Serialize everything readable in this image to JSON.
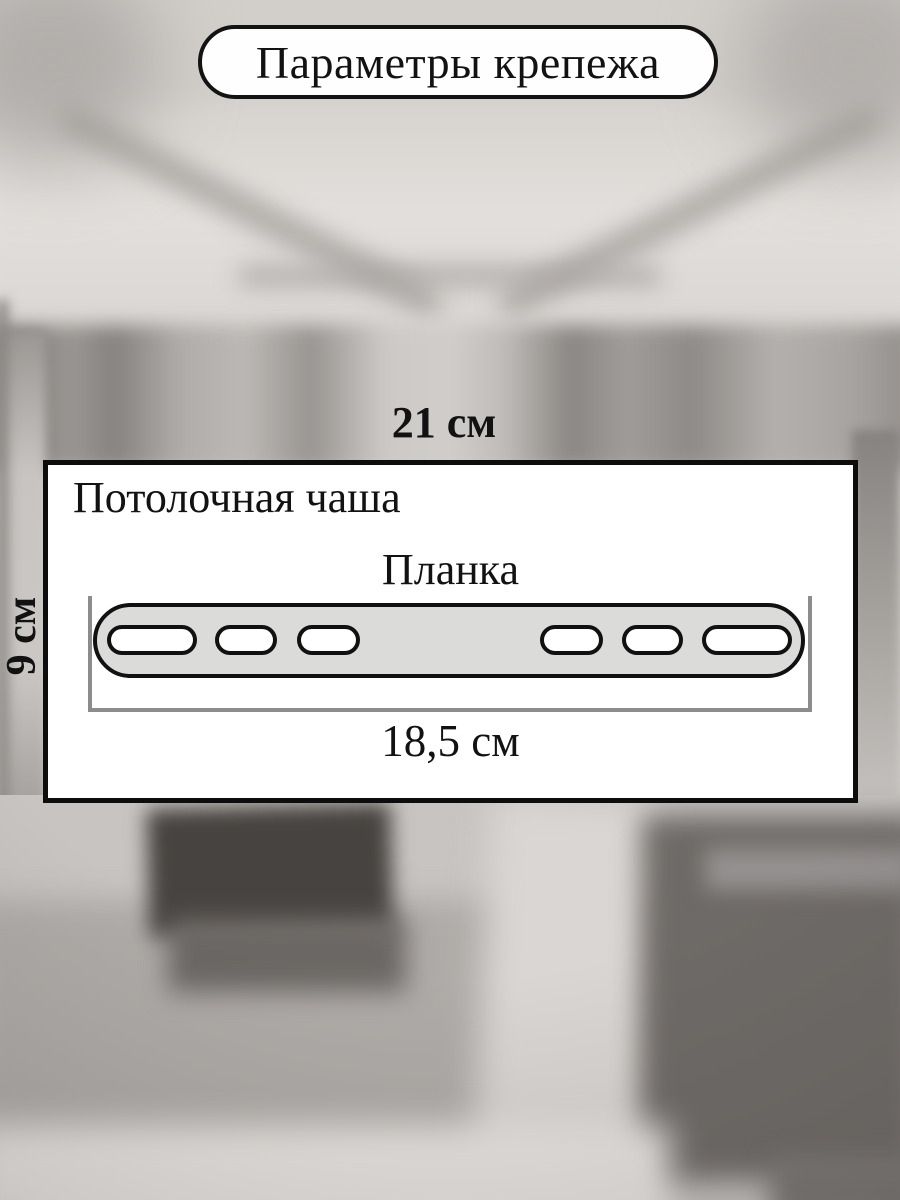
{
  "title": {
    "label": "Параметры крепежа"
  },
  "diagram": {
    "width_dimension": "21 см",
    "part1_label": "Потолочная чаша",
    "part2_label": "Планка",
    "strip_length_dimension": "18,5 см",
    "height_dimension": "9 см",
    "hole_count": 6
  },
  "colors": {
    "outline": "#111111",
    "strip_fill": "#dbdbda",
    "bracket_gray": "#8c8c8c",
    "panel_background": "#ffffff",
    "photo_base": "#d2cfcb"
  }
}
